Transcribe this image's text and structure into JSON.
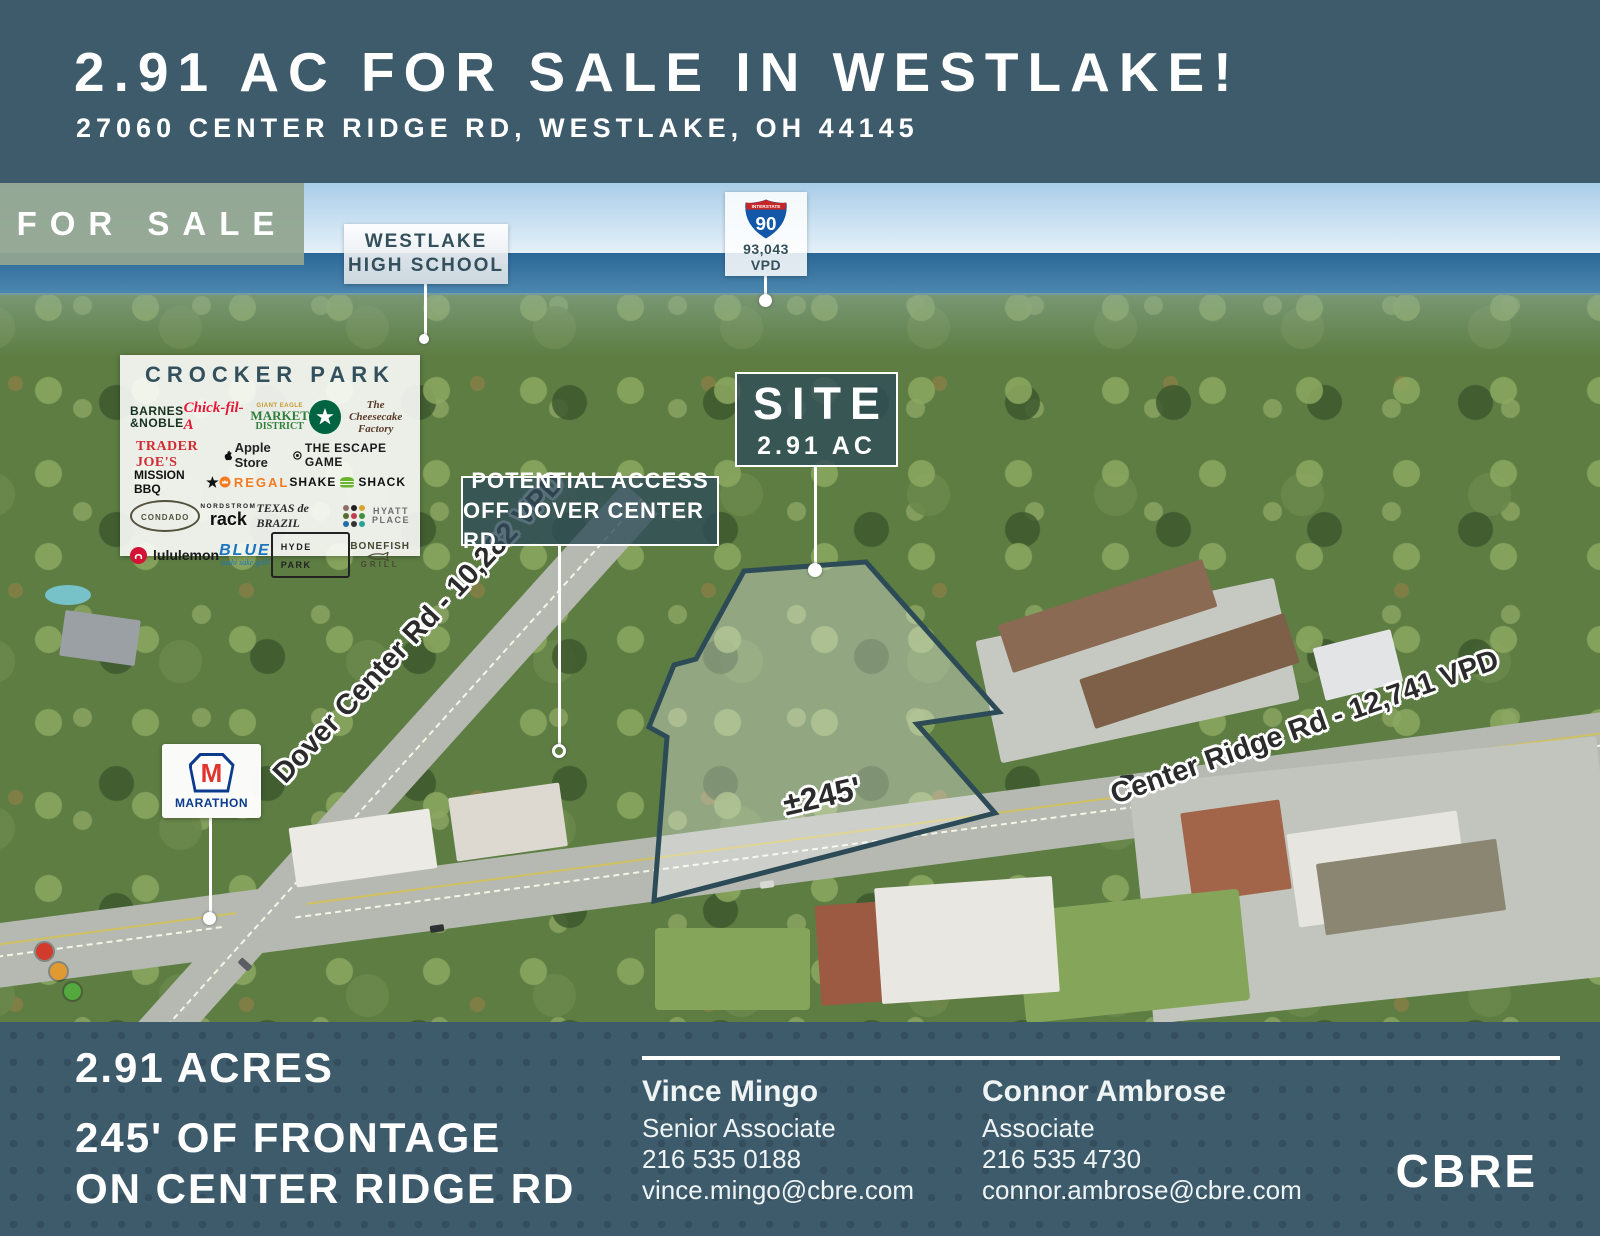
{
  "header": {
    "title": "2.91 AC FOR SALE IN WESTLAKE!",
    "subtitle": "27060 CENTER RIDGE RD, WESTLAKE, OH 44145"
  },
  "for_sale": {
    "label": "FOR SALE"
  },
  "labels": {
    "high_school": {
      "line1": "WESTLAKE",
      "line2": "HIGH SCHOOL"
    },
    "interstate": {
      "shield_top": "INTERSTATE",
      "route": "90",
      "traffic": "93,043",
      "unit": "VPD"
    },
    "site": {
      "title": "SITE",
      "area": "2.91 AC"
    },
    "access": {
      "line1": "POTENTIAL ACCESS",
      "line2": "OFF DOVER CENTER RD"
    },
    "roads": {
      "dover": "Dover Center Rd - 10,282 VPD",
      "center_ridge": "Center Ridge Rd - 12,741 VPD"
    },
    "frontage": "±245'",
    "marathon": {
      "initial": "M",
      "name": "MARATHON"
    }
  },
  "crocker_park": {
    "title": "CROCKER PARK",
    "tenants": [
      {
        "name": "BARNES & NOBLE",
        "line1": "BARNES",
        "line2": "&NOBLE"
      },
      {
        "name": "Chick-fil-A"
      },
      {
        "name": "MARKET DISTRICT",
        "super": "GIANT EAGLE",
        "line1": "MARKET",
        "line2": "DISTRICT"
      },
      {
        "name": "Starbucks",
        "icon": "starbucks-siren"
      },
      {
        "name": "The Cheesecake Factory"
      },
      {
        "name": "TRADER JOE'S"
      },
      {
        "name": "Apple Store",
        "icon": "apple-logo"
      },
      {
        "name": "THE ESCAPE GAME"
      },
      {
        "name": "MISSION BBQ",
        "icon": "star"
      },
      {
        "name": "REGAL",
        "icon": "regal-crown"
      },
      {
        "name": "SHAKE SHACK",
        "part1": "SHAKE",
        "part2": "SHACK",
        "icon": "burger"
      },
      {
        "name": "CONDADO"
      },
      {
        "name": "NORDSTROM rack",
        "line1": "NORDSTROM",
        "line2": "rack"
      },
      {
        "name": "TEXAS de BRAZIL"
      },
      {
        "name": "HYATT PLACE",
        "line1": "HYATT",
        "line2": "PLACE",
        "icon": "hyatt-dots"
      },
      {
        "name": "lululemon",
        "icon": "lululemon-omega"
      },
      {
        "name": "BLUE",
        "sub": "sushi sake grill"
      },
      {
        "name": "HYDE PARK"
      },
      {
        "name": "BONEFISH GRILL",
        "line1": "BONEFISH",
        "line2": "GRILL",
        "icon": "fish"
      }
    ]
  },
  "footer": {
    "stats": {
      "acres": "2.91 ACRES",
      "frontage1": "245' OF FRONTAGE",
      "frontage2": "ON CENTER RIDGE RD"
    },
    "contacts": [
      {
        "name": "Vince Mingo",
        "title": "Senior Associate",
        "phone": "216 535 0188",
        "email": "vince.mingo@cbre.com"
      },
      {
        "name": "Connor Ambrose",
        "title": "Associate",
        "phone": "216 535 4730",
        "email": "connor.ambrose@cbre.com"
      }
    ],
    "brand": "CBRE"
  },
  "colors": {
    "header_bg": "#3e5b6c",
    "for_sale_badge": "#92a491",
    "site_outline": "#2d4b57",
    "site_fill": "rgba(255,255,255,0.33)",
    "lake": "#2c6896"
  }
}
